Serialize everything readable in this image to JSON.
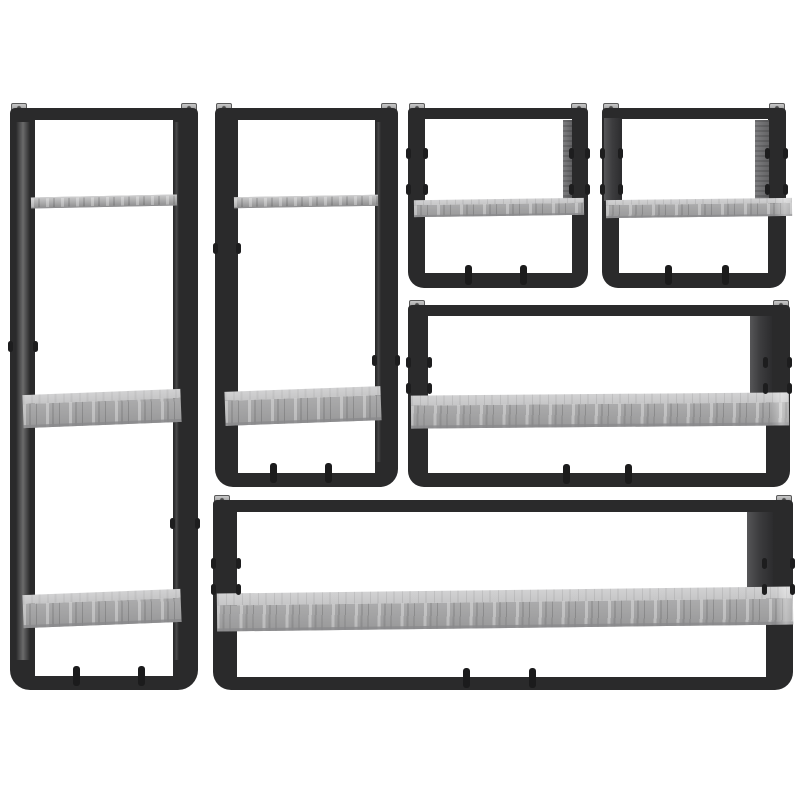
{
  "page": {
    "kind": "product-photo",
    "description": "6-piece wall shelf set with black powder-coated steel frames and grey sonoma oak-look boards on a white background",
    "visible_text": "",
    "background": "#ffffff"
  },
  "palette": {
    "background": "#ffffff",
    "frame": "#2a2a2b",
    "frame_dark": "#1d1d1e",
    "board": "#b2b2b3",
    "board_top": "#c6c6c7",
    "board_shadow": "#8a8a8c",
    "side_panel": "#3d3d3f",
    "bracket": "#a9a9aa"
  },
  "units": [
    {
      "id": "tall-left",
      "label": "Tall wall shelf with 3 boards and black frame"
    },
    {
      "id": "medium-left",
      "label": "Tall wall shelf with 2 boards and black frame"
    },
    {
      "id": "small-square-1",
      "label": "Small square wall shelf with 1 board"
    },
    {
      "id": "small-square-2",
      "label": "Small square wall shelf with 1 board"
    },
    {
      "id": "wide-middle",
      "label": "Wide wall shelf with 1 board"
    },
    {
      "id": "long-bottom",
      "label": "Long wall shelf with 1 board"
    }
  ]
}
